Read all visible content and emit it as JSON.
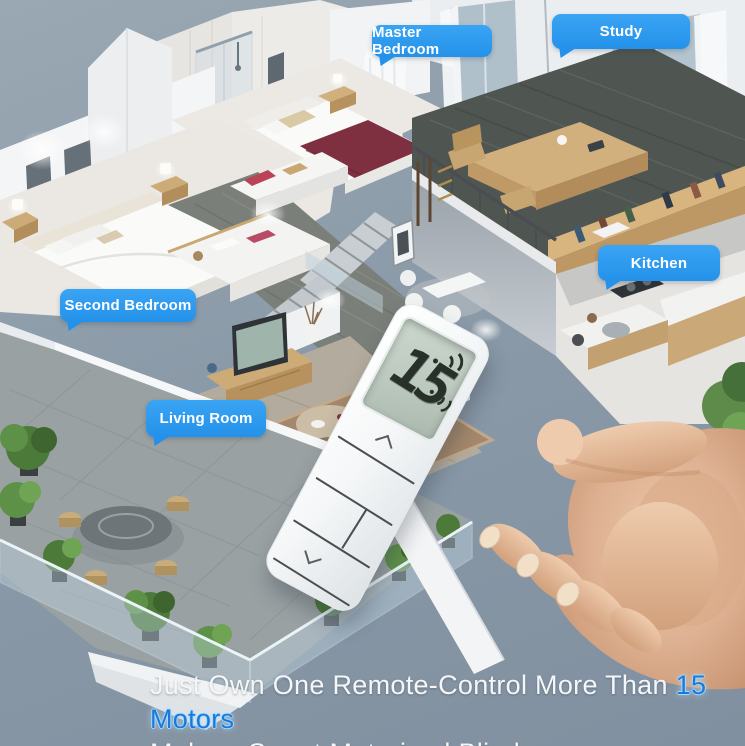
{
  "room_labels": [
    {
      "id": "master-bedroom",
      "label": "Master Bedroom"
    },
    {
      "id": "study",
      "label": "Study"
    },
    {
      "id": "kitchen",
      "label": "Kitchen"
    },
    {
      "id": "second-bedroom",
      "label": "Second Bedroom"
    },
    {
      "id": "living-room",
      "label": "Living Room"
    }
  ],
  "remote": {
    "display_value": "15",
    "signal_icon": "wifi-signal-waves",
    "button_glyphs": {
      "up": "chevron-up",
      "down": "chevron-down"
    }
  },
  "caption": {
    "line1_prefix": "Just Own One Remote-Control More Than ",
    "line1_highlight": "15 Motors",
    "line2": "Make a Smart Motorized Blinds"
  },
  "colors": {
    "background": "#8796a4",
    "label_bubble": "#2b9af0",
    "caption_text": "#f4f6f8",
    "caption_highlight": "#1c79d8",
    "caption_highlight_glow": "#a5d8fa",
    "remote_body": "#f5f7f8",
    "lcd_screen": "#c3cfc5",
    "lcd_digits": "#273029",
    "master_bed_blanket": "#7e3040",
    "wood_furniture": "#d2b07e",
    "plants": "#4c7a38"
  }
}
